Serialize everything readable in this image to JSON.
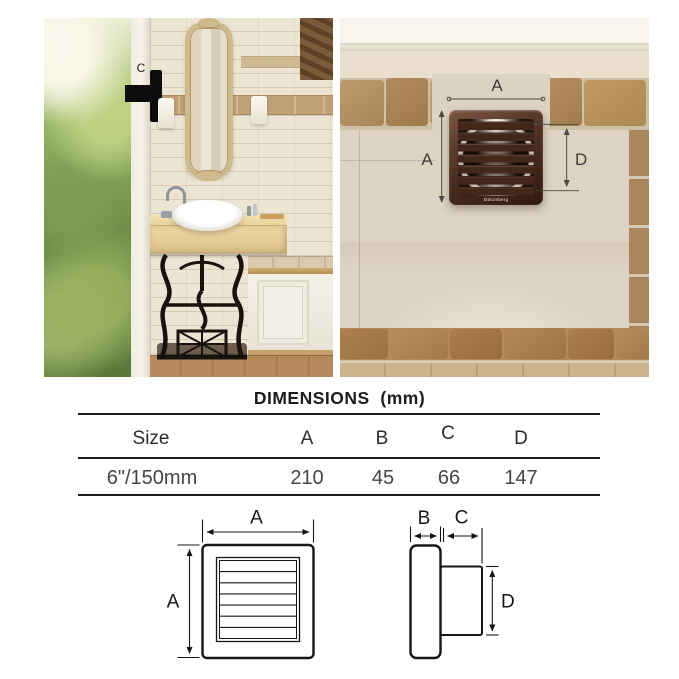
{
  "scene_left": {
    "duct_depth_label": "C"
  },
  "scene_right": {
    "width_label": "A",
    "height_label": "A",
    "diameter_label": "D",
    "brand_logo": "atomberg"
  },
  "dimensions_table": {
    "title": "DIMENSIONS  (mm)",
    "columns": [
      "Size",
      "A",
      "B",
      "C",
      "D"
    ],
    "rows": [
      {
        "size": "6\"/150mm",
        "a": "210",
        "b": "45",
        "c": "66",
        "d": "147"
      }
    ]
  },
  "drawing_front": {
    "width_label": "A",
    "height_label": "A"
  },
  "drawing_side": {
    "frame_depth_label": "B",
    "duct_length_label": "C",
    "duct_diameter_label": "D"
  },
  "colors": {
    "fan_brown": "#5a3a2b",
    "fan_brown_dark": "#33190f",
    "drawing_line": "#161616",
    "annotation_line": "#4a4a4a"
  }
}
